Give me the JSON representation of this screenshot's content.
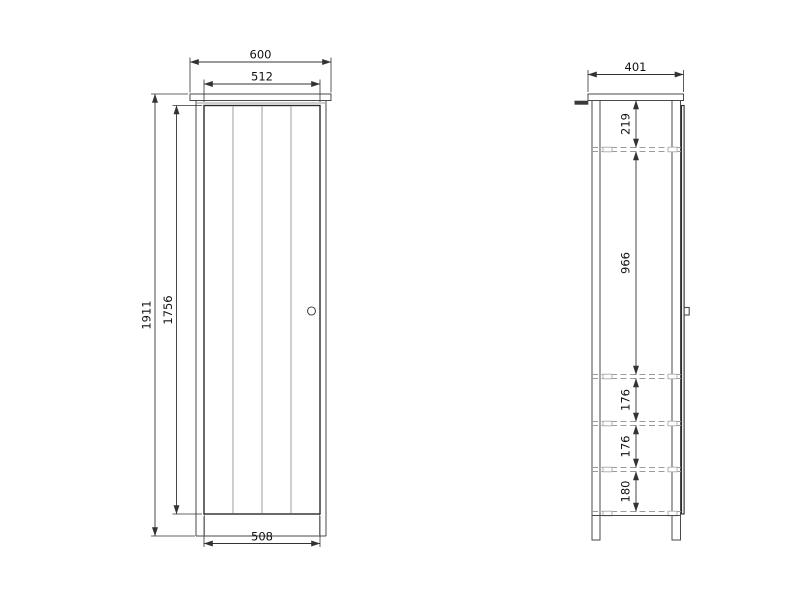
{
  "front_view": {
    "width_overall": "600",
    "door_width": "512",
    "height_overall": "1911",
    "door_height": "1756",
    "bottom_width": "508"
  },
  "side_view": {
    "depth_overall": "401",
    "top_to_first_shelf": "219",
    "first_to_second_shelf": "966",
    "second_to_third_shelf": "176",
    "third_to_fourth_shelf": "176",
    "fourth_shelf_to_bottom": "180"
  },
  "colors": {
    "background": "#ffffff",
    "outline_main": "#4a4a4a",
    "outline_dark": "#2b2b2b",
    "outline_light": "#9e9e9e",
    "hidden_line": "#9b9b9b",
    "dimension_line": "#333333",
    "dimension_text": "#111111"
  }
}
